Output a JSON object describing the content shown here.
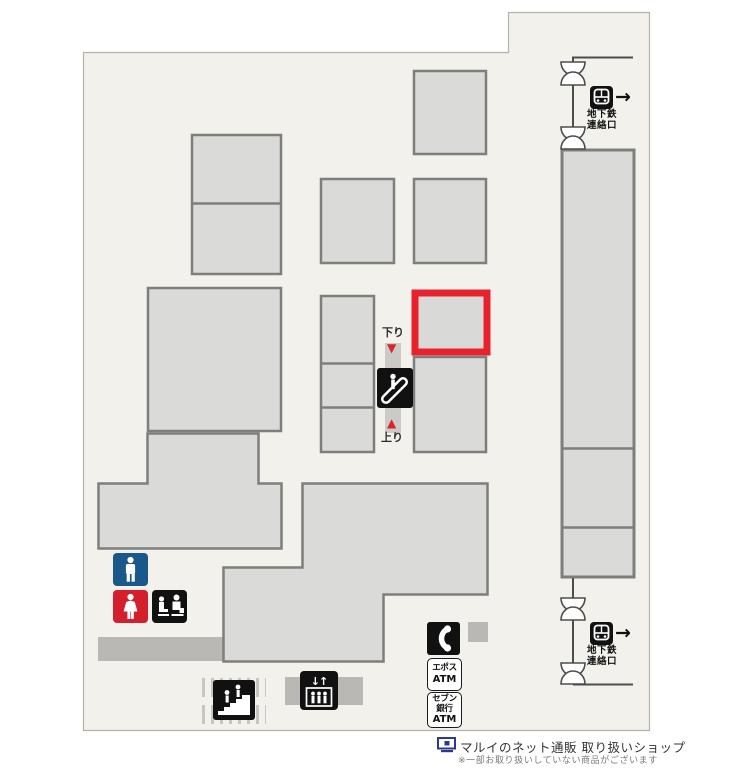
{
  "colors": {
    "map_fill": "#f2f1ec",
    "map_border": "#b3b2ac",
    "building_fill": "#dadad8",
    "building_border": "#7e7e7c",
    "highlight_red": "#e7222d",
    "bar_gray": "#b9b8b4",
    "shaft_gray": "#cbcac6",
    "icon_black": "#111111",
    "toilet_blue": "#1b588a",
    "toilet_red": "#d41f2d",
    "arrow_red": "#da232e",
    "logo_navy": "#2b3a8f"
  },
  "escalator": {
    "down_label": "下り",
    "down_arrow": "▼",
    "up_arrow": "▲",
    "up_label": "上り"
  },
  "subway": {
    "top": {
      "line1": "地下鉄",
      "line2": "連絡口",
      "arrow": "→"
    },
    "bottom": {
      "line1": "地下鉄",
      "line2": "連絡口",
      "arrow": "→"
    }
  },
  "elevator": {
    "arrows": "↓↑"
  },
  "atms": {
    "epos": {
      "line1": "エポス",
      "line2": "ATM"
    },
    "seven": {
      "line1": "セブン",
      "line2": "銀行",
      "line3": "ATM"
    }
  },
  "footer": {
    "title": "マルイのネット通販 取り扱いショップ",
    "note": "※一部お取り扱いしていない商品がございます"
  },
  "icons": {
    "escalator": "escalator-icon",
    "stairs": "stairs-icon",
    "elevator": "elevator-icon",
    "mens_toilet": "mens-toilet-icon",
    "womens_toilet": "womens-toilet-icon",
    "nursing_room": "nursing-room-icon",
    "public_phone": "public-phone-icon",
    "subway_train": "subway-train-icon",
    "ticket_gate": "ticket-gate-icon",
    "net_shop_logo": "monitor-icon"
  }
}
